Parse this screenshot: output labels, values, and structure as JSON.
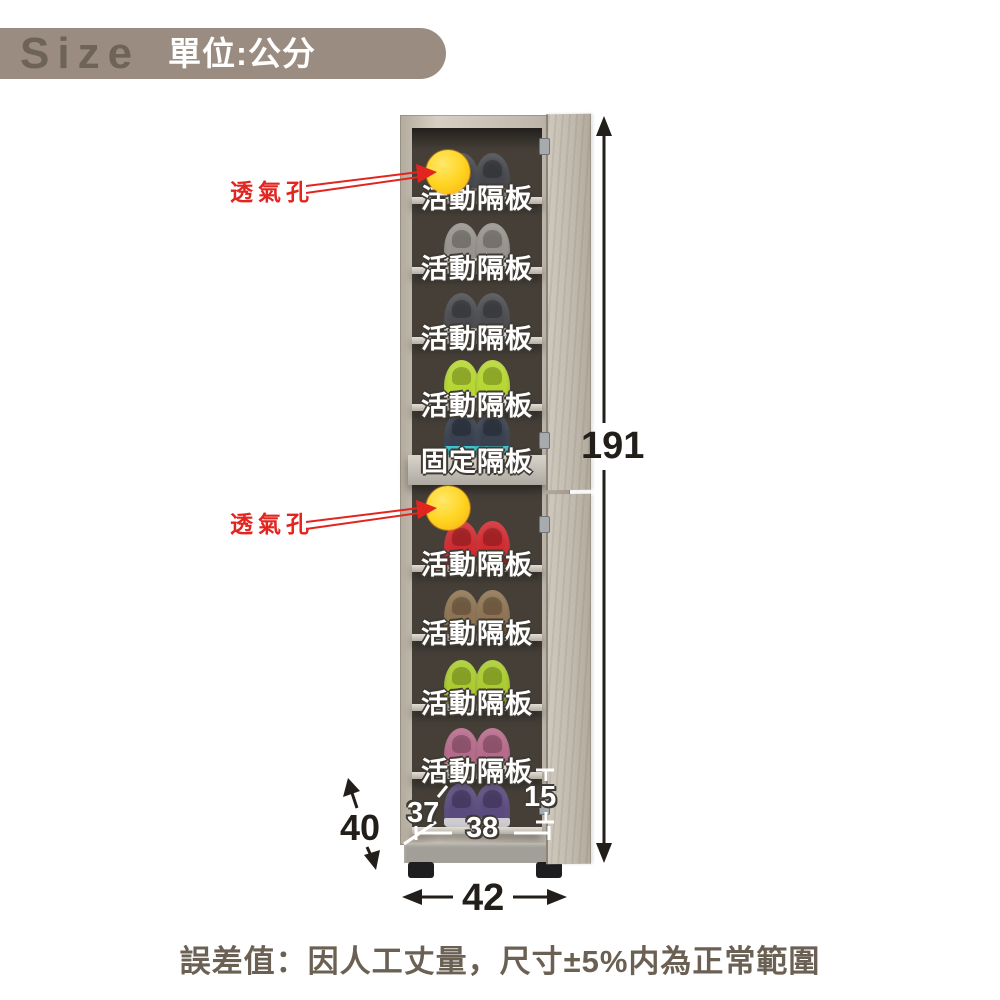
{
  "header": {
    "brand": "Size",
    "unit": "單位:公分"
  },
  "diagram": {
    "vent_label_top": "透氣孔",
    "vent_label_bottom": "透氣孔",
    "shelf_labels": {
      "upper": [
        "活動隔板",
        "活動隔板",
        "活動隔板",
        "活動隔板"
      ],
      "fixed": "固定隔板",
      "lower": [
        "活動隔板",
        "活動隔板",
        "活動隔板",
        "活動隔板"
      ]
    },
    "shoe_rows": [
      {
        "name": "dark-gray-sneakers",
        "main": "#46474c",
        "sole": "#7c7d81"
      },
      {
        "name": "gray-slipons",
        "main": "#97938c",
        "sole": "#e8e6e1"
      },
      {
        "name": "charcoal-sneakers",
        "main": "#4b4c50",
        "sole": "#d8d8da"
      },
      {
        "name": "lime-sneakers",
        "main": "#b6d733",
        "sole": "#e9ece4"
      },
      {
        "name": "teal-sneakers",
        "main": "#39414f",
        "sole": "#3fc4cf"
      },
      {
        "name": "red-sneakers",
        "main": "#d02b30",
        "sole": "#9e1b20"
      },
      {
        "name": "brown-shoes",
        "main": "#8d7352",
        "sole": "#6b4f35"
      },
      {
        "name": "green-sneakers",
        "main": "#aacc2f",
        "sole": "#7d9427"
      },
      {
        "name": "pink-sneakers",
        "main": "#b56a8a",
        "sole": "#dcdcda"
      },
      {
        "name": "purple-sneakers",
        "main": "#5a4b7e",
        "sole": "#cfcdd2"
      }
    ],
    "dimensions": {
      "height_cm": "191",
      "width_cm": "42",
      "depth_cm": "40",
      "inner_depth_cm": "37",
      "inner_width_cm": "38",
      "bottom_shelf_height_cm": "15"
    },
    "colors": {
      "accent_red": "#e2251f",
      "vent_yellow": "#ffd21e",
      "banner_taupe": "#9a8c80",
      "dimension_black": "#221e1a"
    }
  },
  "footnote": "誤差值：因人工丈量，尺寸±5%内為正常範圍"
}
